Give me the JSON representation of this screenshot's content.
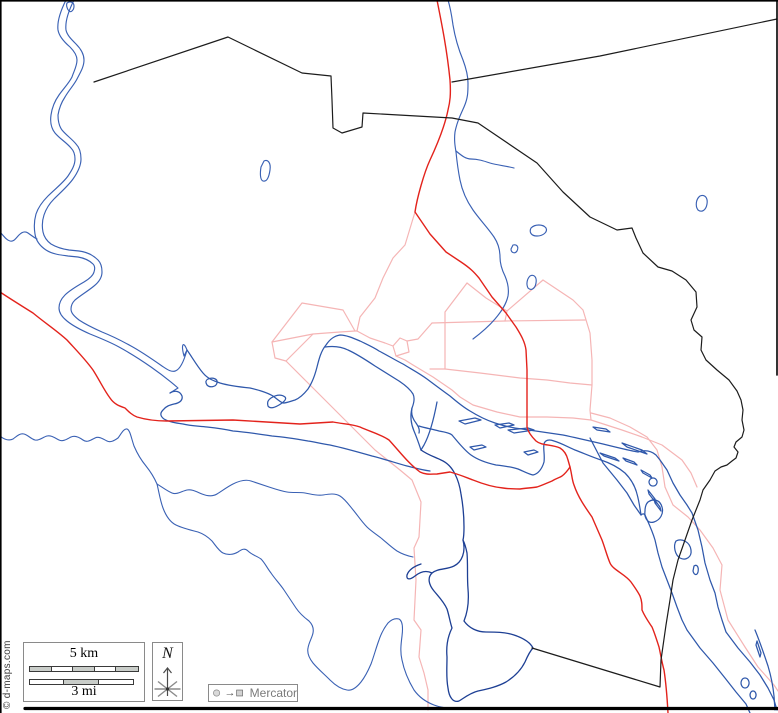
{
  "legend": {
    "scale_km": "5 km",
    "scale_mi": "3 mi",
    "north": "N",
    "projection": "Mercator",
    "projection_arrow": "→",
    "copyright": "© d-maps.com",
    "km_segments": [
      "gray",
      "white",
      "gray",
      "white",
      "gray"
    ],
    "mi_segments": [
      "white",
      "gray",
      "white"
    ]
  },
  "colors": {
    "water": "#3a61b4",
    "water_dark": "#1d3f94",
    "road": "#e3231c",
    "road_minor": "#f5b5b5",
    "boundary": "#1c1c1c",
    "frame": "#000000",
    "bar_gray": "#c9cdc9",
    "bar_white": "#ffffff",
    "symbol_fill": "#d9d9d9",
    "symbol_stroke": "#8a8a8a"
  },
  "map": {
    "width": 778,
    "height": 713,
    "layers": [
      {
        "name": "minor-road-pink",
        "color": "#f5b5b5",
        "width": 1.2,
        "paths": [
          "M415,212 L405,245 L393,258 L383,278 L375,298 L360,317 L357,331 L370,338 L385,343 L393,346",
          "M393,346 L400,338 L407,341 L409,352 L396,356 L393,346",
          "M407,341 L418,339 L432,323",
          "M432,323 L505,321 L585,320",
          "M467,283 L445,312 L445,369",
          "M467,283 L486,298 L507,311 L505,321",
          "M543,280 L507,311",
          "M543,280 L573,300 L583,310 L590,333 L592,360 L592,385 L590,410 L591,420",
          "M430,369 L445,369 L480,373 L520,378 L547,380 L570,383 L592,385",
          "M396,356 L405,360 L413,365 L433,377 L452,390 L460,397 L473,405 L497,412 L520,417 L547,417 L573,418 L591,420 L622,430 L642,437 L662,445 L682,460 L691,473 L697,487",
          "M591,413 L610,418 L630,427 L647,437 L657,450 L662,467 L665,487 L673,505 L688,517 L700,530 L713,548 L722,565 L720,590 L728,620 L745,647 L758,667 L774,685 L778,691",
          "M272,342 L302,303 L343,310 L355,331 L357,331",
          "M355,331 L340,332 L313,334 L272,342",
          "M272,342 L275,358 L286,361 L313,334",
          "M286,361 L310,385 L340,415 L375,450 L400,470 L412,480 L421,502 L419,537 L414,548 L416,580 L414,620 L421,630 L419,657 L424,673 L428,690 L428,710"
        ]
      },
      {
        "name": "river",
        "color": "#3a61b4",
        "width": 1.15,
        "paths": [
          "M66,0 C60,12 57,22 58,30 C59,36 63,41 70,47 C75,52 77,56 77,60 C77,66 74,71 72,77 C69,83 64,88 59,95 C54,102 52,108 51,115 C50,122 51,128 55,133 C60,139 66,142 71,148 C74,151 75,155 75,159 C75,165 72,170 68,176 C63,183 55,189 48,196 C42,202 38,208 36,214 C34,221 34,228 35,234 C36,241 40,246 46,250 C52,254 60,255 68,256 L78,257 C84,258 89,260 93,264 C95,266 95,269 94,272 C93,276 89,279 84,282 C77,286 70,290 65,295 C61,299 59,303 59,308 C59,313 62,317 67,321 C73,326 81,330 90,334 C100,338 110,342 119,347 C130,353 141,360 151,367 C161,374 170,381 178,388 L170,393",
          "M74,0 C68,12 65,22 66,30 C67,35 71,39 76,44 C81,49 84,54 84,60 C84,67 80,73 77,79 C74,85 69,90 65,97 C61,103 59,109 58,115 C58,121 59,126 62,130 C66,135 72,139 76,144 C80,148 81,153 81,159 C81,166 78,172 73,179 C68,186 61,192 54,199 C49,204 46,209 44,215 C42,221 42,227 43,232 C44,237 47,241 51,244 C56,247 62,249 69,250 L79,251 C87,252 93,255 98,260 C101,263 102,267 102,272 C102,277 99,282 94,286 C88,291 81,295 75,300 C72,303 71,306 71,309 C71,313 74,316 79,320 C85,324 93,328 102,332 C112,336 122,341 131,346 C142,352 152,359 162,366 C171,372 179,379 187,350 M187,350 C183,340 181,345 184,356 L187,350",
          "M67,3 C70,1 74,2 74,6 C74,10 71,13 69,11 C67,9 66,5 67,3",
          "M0,232 C4,236 6,240 10,241 C14,242 16,238 19,235 C22,232 25,231 28,233 C31,235 33,237 37,239",
          "M264,161 C268,159 271,163 270,170 C269,177 267,182 263,181 C260,180 260,173 261,167 Z",
          "M448,0 C451,10 452,18 453,25 C455,37 458,48 463,60 C466,68 468,76 468,83 C468,92 468,98 464,107 C460,116 457,122 455,132 C454,140 455,146 456,152 C457,162 458,170 460,180 C462,190 466,200 473,210 C480,220 488,228 494,237 C498,243 500,250 500,257 C500,264 502,270 505,276 C508,283 509,290 508,296 C506,305 501,312 495,319 C489,326 481,333 473,339",
          "M456,151 C462,156 466,159 471,159 C478,159 484,161 490,163 C497,165 506,166 514,168",
          "M531,228 C535,224 543,224 546,228 C548,232 543,236 537,236 C531,236 529,232 531,228 Z",
          "M513,245 C517,244 519,247 517,251 C515,254 511,253 511,249 Z",
          "M530,276 C534,274 537,277 536,283 C535,289 531,291 528,288 C526,284 527,279 530,276 Z",
          "M700,196 C705,194 708,198 707,204 C706,210 702,213 698,210 C695,206 696,199 700,196 Z"
        ]
      },
      {
        "name": "river-main",
        "color": "#2f58ab",
        "width": 1.25,
        "paths": [
          "M187,350 C192,357 197,366 203,373 C208,379 214,381 220,383 C230,386 240,387 250,388 C258,390 266,392 273,396 C277,399 280,402 283,403 C287,403 291,401 295,400 C300,398 304,394 308,389 C312,383 315,375 317,367 C319,359 321,351 326,345 C330,339 334,336 340,335 C346,335 353,338 360,341 C366,344 373,347 379,351 C387,355 395,360 403,364 C411,369 419,373 427,379 C435,385 443,391 450,396 C457,402 463,407 470,411 C478,416 486,420 495,423 C504,426 513,428 522,429 C536,431 550,433 563,435 C577,438 590,441 603,444 C615,447 627,450 638,452 C644,450 650,450 656,455 L660,460 L667,470 L673,483 L680,495 L687,505 L692,513 L698,530 L702,547 L705,563 L710,580 L715,593 L718,607 L722,620 L726,632 L738,648 L750,662 L760,675 L768,688 L774,700 L777,710",
          "M170,393 C175,390 180,391 182,396 C183,400 180,403 174,404 C170,405 166,406 163,410 C160,413 160,416 164,419 C169,422 176,423 183,424 C191,426 199,426 207,427 C216,428 224,429 233,431 C246,432 259,434 272,436 C285,437 297,439 308,441 C315,442 322,444 330,445 C344,448 358,452 372,456 C384,459 396,463 407,466 C415,468 422,470 430,471",
          "M325,347 C332,346 340,346 348,350 C357,354 366,360 375,366 C383,371 391,376 399,381 C405,385 410,389 413,394 C415,398 414,403 412,408 C411,413 412,418 416,423 C418,426 420,429 419,433",
          "M419,426 C425,428 432,429 439,431 C445,432 450,433 452,435 C458,442 464,450 471,455 C478,460 487,463 496,465 C505,466 512,467 518,469 C523,471 528,474 533,475 C538,474 542,469 544,462 C545,455 543,449 544,444 C545,440 549,439 554,441 C561,443 568,447 575,450 C583,453 592,457 601,460 C610,463 618,467 625,473 C631,479 635,486 637,494 C639,501 640,508 641,515 C643,513 644,514 645,515 C648,522 652,530 655,540 L658,553 L662,567 L667,580 L672,593 L677,607 L682,620 L687,630 L700,648 L713,663 L725,678 L736,692 L746,704 L750,713",
          "M590,438 L603,463 L617,480 L627,493 L634,505 L641,515",
          "M412,408 C410,416 411,424 414,431 C417,438 419,444 421,450",
          "M437,402 C434,418 430,434 424,445 L421,450",
          "M208,379 C213,377 218,379 217,383 C216,387 210,388 207,385 C205,382 206,380 208,379 Z",
          "M271,398 C276,395 281,394 285,397 C287,399 284,402 279,405 C274,408 270,409 268,406 C267,402 268,400 271,398 Z",
          "M459,421 l16,-3 l6,2 l-16,4 z",
          "M495,425 l14,-2 l5,2 l-14,3 z",
          "M508,430 l20,-2 l6,2 l-20,3 z",
          "M470,447 l12,-2 l4,2 l-12,3 z",
          "M524,452 l10,-2 l4,2 l-10,3 z",
          "M593,427 l13,2 l4,3 l-13,-2 z",
          "M622,443 l20,7 l5,4 l-20,-7 z",
          "M600,453 l15,5 l4,3 l-15,-5 z",
          "M623,458 l11,4 l3,3 l-11,-4 z",
          "M641,470 l9,5 l2,3 l-9,-5 z",
          "M653,478 a4,4 0 1,0 0.1,0 z",
          "M648,490 l7,9 l1,4 l-7,-9 z",
          "M654,499 l6,8 l1,4 l-6,-8 z",
          "M676,541 C682,538 690,542 691,550 C692,557 686,561 680,558 C675,555 673,546 676,541 Z",
          "M694,566 C697,564 699,567 698,572 C697,576 694,575 693,571 Z",
          "M648,502 C654,498 660,500 662,507 C664,514 660,520 654,522 C648,524 644,518 645,511 C645,507 646,504 648,502 Z",
          "M757,641 l4,12 l-1,4 l-4,-12 z",
          "M745,678 a4,5 0 1,0 0.1,0 z",
          "M753,691 a3,4 0 1,0 0.1,0 z",
          "M755,630 C760,642 764,654 768,666 C771,676 773,686 774,696 L775,710"
        ]
      },
      {
        "name": "stream",
        "color": "#3a61b4",
        "width": 1.1,
        "paths": [
          "M0,436 C5,440 9,441 13,439 C17,436 20,433 24,434 C28,435 31,439 35,440 C39,441 43,437 47,436 C51,435 55,438 59,440 C63,442 67,439 71,437 C75,435 79,437 83,440 C87,443 91,440 95,438 C99,436 103,439 107,441 C111,443 115,440 118,438 C121,434 124,428 127,429 C130,430 131,437 134,446 C137,453 141,460 146,466 C150,471 154,477 157,484 C159,492 160,500 163,508 C166,516 170,522 176,525 C182,528 190,530 198,532 C204,534 208,537 212,541 C216,546 219,551 223,553 C227,555 233,555 238,552 C242,549 245,548 248,551 C252,555 257,556 261,559 C265,563 267,568 271,573 C275,579 280,584 284,590 C288,596 292,602 296,608 C300,614 305,618 309,621 C312,624 314,628 313,633 C312,638 309,642 308,648 C307,653 309,658 313,663 C318,669 324,674 330,680 C335,685 341,689 347,690 C352,691 357,687 361,682 C365,677 368,671 371,664 C374,656 376,648 379,640 C381,634 384,628 388,623 C391,620 395,618 399,619 C403,621 403,628 402,636 C401,644 400,652 402,660 C404,670 408,680 414,690 C419,697 426,702 434,705 C441,708 448,708 454,708",
          "M157,484 C162,487 167,491 172,493 C177,495 182,491 187,490 C192,489 197,492 202,494 C207,496 212,497 217,494 C222,491 227,487 233,484 C239,481 245,479 251,481 C257,483 263,485 269,487 C275,489 281,491 287,492 C293,493 299,492 305,493 C311,494 317,496 323,495 C329,494 335,493 340,496 C345,499 349,505 354,511 C358,516 362,522 367,527 C371,531 376,534 381,538 C386,542 391,547 397,551 C402,554 408,556 413,557"
        ]
      },
      {
        "name": "lake-dark",
        "color": "#1d3f94",
        "width": 1.3,
        "paths": [
          "M421,450 C428,455 435,457 441,460 C448,463 452,468 455,474 C458,480 460,487 461,494 C463,505 464,516 464,527 C464,532 464,536 463,540",
          "M463,540 C466,552 462,562 454,566 C446,570 438,568 432,573 C427,578 429,585 434,591 C439,597 444,602 447,609 C449,615 450,622 452,628 C448,636 446,646 447,657 C447,668 446,678 448,688 C449,697 453,703 459,701 C464,698 470,693 478,691 C487,689 497,687 506,682 C514,677 521,670 525,662 C528,655 531,650 533,648 C530,642 523,638 514,635 C505,632 495,632 486,632 C477,632 469,628 464,621 C468,611 469,600 468,589 C467,577 468,565 467,553 C466,548 465,544 463,540 Z",
          "M432,573 C426,570 420,572 415,576 C410,580 406,580 407,575 C409,569 415,566 421,564"
        ]
      },
      {
        "name": "road-red",
        "color": "#e3231c",
        "width": 1.4,
        "paths": [
          "M437,0 C442,25 447,50 450,80 C451,95 450,102 448,110 C445,125 437,145 430,160 C424,173 417,198 415,212 L430,234 L446,252 L461,262 C470,268 474,272 479,278 L492,297 L506,313 L516,327 C521,335 525,342 526,350 L527,370 L527,413 L527,427 C528,432 531,436 536,441 C542,446 551,444 560,448 C565,451 567,456 568,460 L570,467 C572,475 572,480 574,485 C578,497 585,507 592,517 L602,540 C605,548 607,556 610,563 C613,570 625,574 631,582 C636,589 638,592 640,596 C642,601 642,605 642,610 C645,617 648,621 652,627 C655,634 657,641 659,647 C661,656 662,663 664,670 C666,683 667,695 668,713",
          "M0,292 C12,300 22,306 33,313 C45,323 56,330 67,340 C77,351 85,359 93,370 C100,381 104,390 110,398 C114,404 119,406 125,408 C129,412 132,415 137,417 C147,420 157,421 167,421 L233,420 L300,424 L333,422 C343,424 352,424 360,427 C371,432 380,434 389,440 C400,452 408,463 420,472 C426,475 431,474 437,474 L450,472 C458,474 465,477 473,480 C483,484 492,487 503,488 C509,489 514,489 520,489 C526,488 531,488 537,487 C543,485 547,483 552,481 C557,478 559,478 562,476 C566,473 568,470 570,467"
        ]
      },
      {
        "name": "boundary",
        "color": "#1c1c1c",
        "width": 1.2,
        "paths": [
          "M94,82 L228,37 L302,73 L331,76 L332,100 L333,128 L342,133 L362,127 L363,113 L452,118 L478,123 L537,163 L563,192 L590,217 L617,230 L632,228 L636,238 L643,253 L658,267 L672,271 L686,280 L696,292 L697,307 L691,320 L694,330 L702,337 L701,350 L706,360 L717,370 L729,380 L737,391 L741,400 L743,410 L742,420 L744,430 L742,437 L736,442 L734,447 L738,452 L736,458 L732,461 L727,465 L721,467 L715,471 L710,480 L703,490 L700,500 L692,520 L685,540 L678,560 L673,580 L670,600 L666,625 L661,660 L660,687 L532,648",
          "M452,82 L600,56 L777,19"
        ]
      },
      {
        "name": "frame",
        "color": "#000000",
        "width": 1.6,
        "paths": [
          "M0,0.8 L778,0.8",
          "M0.8,0 L0.8,713",
          "M777,0 L777,375"
        ]
      },
      {
        "name": "frame-bottom",
        "color": "#000000",
        "width": 3.2,
        "paths": [
          "M25,708.5 L778,708.5"
        ]
      }
    ]
  }
}
